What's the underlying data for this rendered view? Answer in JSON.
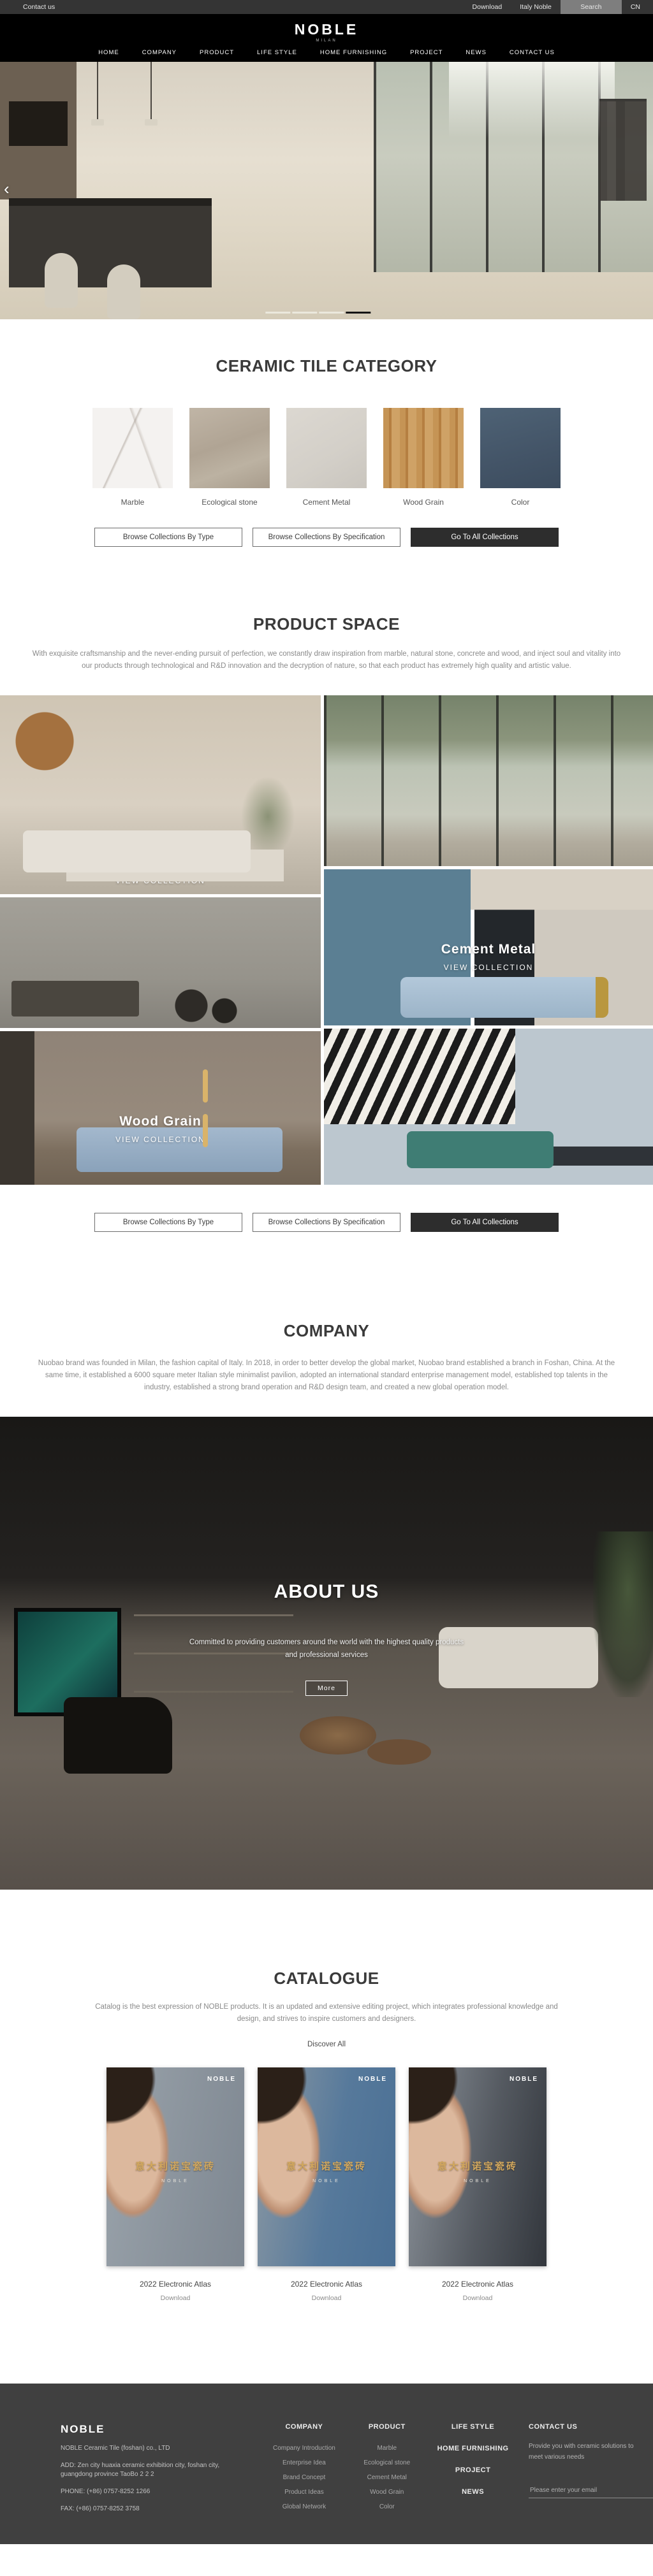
{
  "topbar": {
    "contact": "Contact us",
    "download": "Download",
    "italy_noble": "Italy Noble",
    "search": "Search",
    "lang": "CN"
  },
  "header": {
    "logo": "NOBLE",
    "tagline": "MILAN"
  },
  "nav": {
    "items": [
      "HOME",
      "COMPANY",
      "PRODUCT",
      "LIFE STYLE",
      "HOME FURNISHING",
      "PROJECT",
      "NEWS",
      "CONTACT US"
    ]
  },
  "hero": {
    "prev_arrow": "‹",
    "slide_count": 4,
    "active_slide": 4
  },
  "category": {
    "title": "CERAMIC TILE CATEGORY",
    "items": [
      {
        "label": "Marble",
        "color": "#f4f2f0"
      },
      {
        "label": "Ecological stone",
        "color": "#b5a996"
      },
      {
        "label": "Cement Metal",
        "color": "#d6d2cb"
      },
      {
        "label": "Wood Grain",
        "color": "#c59455"
      },
      {
        "label": "Color",
        "color": "#46586a"
      }
    ]
  },
  "browse_buttons": {
    "by_type": "Browse Collections By Type",
    "by_spec": "Browse Collections By Specification",
    "all": "Go To All Collections"
  },
  "product_space": {
    "title": "PRODUCT SPACE",
    "paragraph": "With exquisite craftsmanship and the never-ending pursuit of perfection, we constantly draw inspiration from marble, natural stone, concrete and wood, and inject soul and vitality into our products through technological and R&D innovation and the decryption of nature, so that each product has extremely high quality and artistic value.",
    "view_collection": "VIEW COLLECTION",
    "tiles": [
      {
        "caption": "Marbl"
      },
      {
        "caption": "Cement Metal"
      },
      {
        "caption": "Wood Grain"
      }
    ]
  },
  "company": {
    "title": "COMPANY",
    "paragraph": "Nuobao brand was founded in Milan, the fashion capital of Italy. In 2018, in order to better develop the global market, Nuobao brand established a branch in Foshan, China. At the same time, it established a 6000 square meter Italian style minimalist pavilion, adopted an international standard enterprise management model, established top talents in the industry, established a strong brand operation and R&D design team, and created a new global operation model."
  },
  "about": {
    "title": "ABOUT US",
    "line1": "Committed to providing customers around the world with the highest quality products",
    "line2": "and professional services",
    "more": "More"
  },
  "catalogue": {
    "title": "CATALOGUE",
    "paragraph": "Catalog is the best expression of NOBLE products. It is an updated and extensive editing project, which integrates professional knowledge and design, and strives to inspire customers and designers.",
    "discover": "Discover All",
    "posters": [
      {
        "brand": "NOBLE",
        "title_cn": "意大利诺宝瓷砖",
        "label": "2022 Electronic Atlas",
        "download": "Download"
      },
      {
        "brand": "NOBLE",
        "title_cn": "意大利诺宝瓷砖",
        "label": "2022 Electronic Atlas",
        "download": "Download"
      },
      {
        "brand": "NOBLE",
        "title_cn": "意大利诺宝瓷砖",
        "label": "2022 Electronic Atlas",
        "download": "Download"
      }
    ]
  },
  "footer": {
    "brand": "NOBLE",
    "company_name": "NOBLE Ceramic Tile (foshan) co., LTD",
    "address": "ADD:  Zen city huaxia ceramic exhibition city, foshan city, guangdong province TaoBo 2 2 2",
    "phone": "PHONE:   (+86)  0757-8252 1266",
    "fax": "FAX:   (+86)  0757-8252 3758",
    "columns": [
      {
        "title": "COMPANY",
        "links": [
          "Company Introduction",
          "Enterprise Idea",
          "Brand Concept",
          "Product Ideas",
          "Global Network"
        ]
      },
      {
        "title": "PRODUCT",
        "links": [
          "Marble",
          "Ecological stone",
          "Cement Metal",
          "Wood Grain",
          "Color"
        ]
      }
    ],
    "nav_headers": [
      "LIFE STYLE",
      "HOME FURNISHING",
      "PROJECT",
      "NEWS"
    ],
    "contact": {
      "title": "CONTACT US",
      "text": "Provide you with ceramic solutions to meet various needs",
      "email_placeholder": "Please enter your email"
    }
  },
  "colors": {
    "accent_dark": "#2d2d2d",
    "footer_bg": "#404040",
    "gold": "#d2a75c",
    "topbar_bg": "#343434"
  }
}
